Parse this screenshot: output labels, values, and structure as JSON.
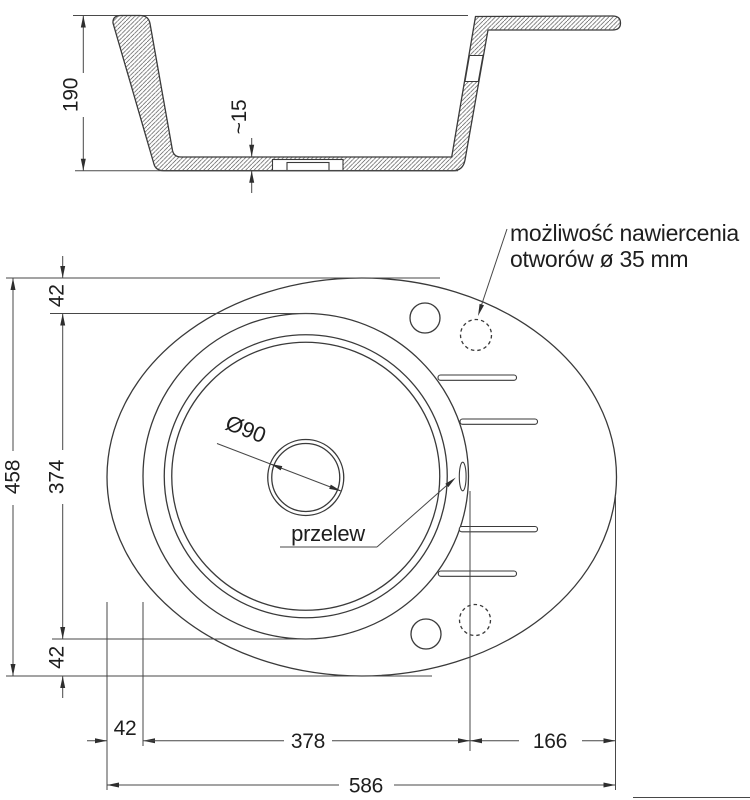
{
  "colors": {
    "line": "#3a3a3a",
    "dim": "#474747",
    "text": "#1e1e1e",
    "bg": "#ffffff"
  },
  "section_view": {
    "height_label": "190",
    "floor_label": "~15"
  },
  "plan_view": {
    "note_line1": "możliwość nawiercenia",
    "note_line2": "otworów ø 35 mm",
    "drain_label": "Ø90",
    "overflow_label": "przelew",
    "dim_top_margin": "42",
    "dim_bowl_height": "374",
    "dim_total_height": "458",
    "dim_bottom_margin": "42",
    "dim_left_margin": "42",
    "dim_bowl_width": "378",
    "dim_drainer_width": "166",
    "dim_total_width": "586"
  }
}
